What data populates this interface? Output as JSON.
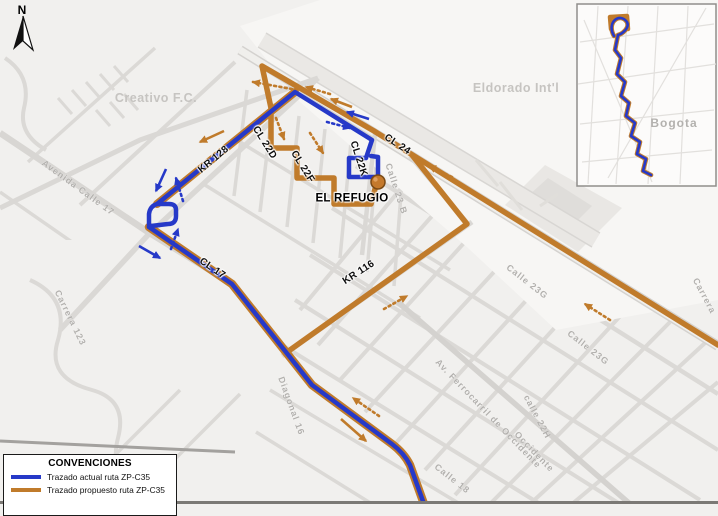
{
  "legend": {
    "title": "CONVENCIONES",
    "items": [
      {
        "label": "Trazado actual ruta ZP-C35",
        "color": "#2639c8"
      },
      {
        "label": "Trazado propuesto ruta ZP-C35",
        "color": "#c07b2b"
      }
    ]
  },
  "colors": {
    "route_current": "#2639c8",
    "route_proposed": "#c07b2b",
    "road": "#dbd9d6",
    "road_major": "#d4d2cf",
    "background": "#f1f0ee",
    "label_gray": "#b2b0ad",
    "stop_fill": "#c4792c",
    "stop_border": "#7a4a15",
    "frame": "#7b7975"
  },
  "stop": {
    "name": "EL REFUGIO",
    "x": 378,
    "y": 182
  },
  "inset": {
    "city_label": "Bogota"
  },
  "north_label": "N",
  "labels": [
    {
      "t": "N",
      "x": 22,
      "y": 10,
      "r": 0,
      "cls": "north",
      "name": "north-label"
    },
    {
      "t": "Creativo F.C.",
      "x": 156,
      "y": 98,
      "r": 0,
      "cls": "glbig",
      "name": "street-label"
    },
    {
      "t": "Eldorado Int'l",
      "x": 516,
      "y": 88,
      "r": 0,
      "cls": "glbig",
      "name": "airport-label"
    },
    {
      "t": "Avenida  Calle  17",
      "x": 78,
      "y": 188,
      "r": 36,
      "cls": "gl",
      "name": "street-label"
    },
    {
      "t": "KR 128",
      "x": 214,
      "y": 160,
      "r": -40,
      "cls": "rl",
      "name": "route-street-label"
    },
    {
      "t": "CL 22D",
      "x": 264,
      "y": 143,
      "r": 58,
      "cls": "rl",
      "name": "route-street-label"
    },
    {
      "t": "CL 22F",
      "x": 302,
      "y": 167,
      "r": 58,
      "cls": "rl",
      "name": "route-street-label"
    },
    {
      "t": "CL 22K",
      "x": 358,
      "y": 159,
      "r": 72,
      "cls": "rl",
      "name": "route-street-label"
    },
    {
      "t": "CL 24",
      "x": 397,
      "y": 145,
      "r": 33,
      "cls": "rl",
      "name": "route-street-label"
    },
    {
      "t": "CL 17",
      "x": 212,
      "y": 269,
      "r": 34,
      "cls": "rl",
      "name": "route-street-label"
    },
    {
      "t": "KR 116",
      "x": 359,
      "y": 273,
      "r": -33,
      "cls": "rl",
      "name": "route-street-label"
    },
    {
      "t": "EL REFUGIO",
      "x": 352,
      "y": 199,
      "r": 0,
      "cls": "refugio",
      "name": "stop-label"
    },
    {
      "t": "Calle 23 B",
      "x": 396,
      "y": 189,
      "r": 72,
      "cls": "gl",
      "name": "street-label"
    },
    {
      "t": "Calle 23G",
      "x": 527,
      "y": 282,
      "r": 38,
      "cls": "gl",
      "name": "street-label"
    },
    {
      "t": "Calle 23G",
      "x": 588,
      "y": 348,
      "r": 38,
      "cls": "gl",
      "name": "street-label"
    },
    {
      "t": "Carrera",
      "x": 704,
      "y": 296,
      "r": 62,
      "cls": "gl",
      "name": "street-label"
    },
    {
      "t": "Av. Ferrocarril de Occidente",
      "x": 488,
      "y": 414,
      "r": 46,
      "cls": "gl",
      "name": "street-label"
    },
    {
      "t": "calle 22H",
      "x": 537,
      "y": 417,
      "r": 62,
      "cls": "gl",
      "name": "street-label"
    },
    {
      "t": "Occidente",
      "x": 534,
      "y": 452,
      "r": 46,
      "cls": "gl",
      "name": "street-label"
    },
    {
      "t": "Diagonal  16",
      "x": 291,
      "y": 406,
      "r": 70,
      "cls": "gl",
      "name": "street-label"
    },
    {
      "t": "Calle 18",
      "x": 452,
      "y": 479,
      "r": 38,
      "cls": "gl",
      "name": "street-label"
    },
    {
      "t": "Carrera 123",
      "x": 70,
      "y": 318,
      "r": 64,
      "cls": "gl",
      "name": "street-label"
    },
    {
      "t": "Bogota",
      "x": 674,
      "y": 123,
      "r": 0,
      "cls": "city",
      "name": "inset-city-label"
    }
  ],
  "elements": [
    {
      "k": "rect",
      "x": 0,
      "y": 0,
      "w": 718,
      "h": 504,
      "f": "#f1f0ee",
      "name": "map-background"
    },
    {
      "k": "path",
      "d": "M332,208 L718,450",
      "w": 4,
      "c": "#dbd9d6",
      "name": "street"
    },
    {
      "k": "path",
      "d": "M310,255 L700,500",
      "w": 4,
      "c": "#dbd9d6",
      "name": "street"
    },
    {
      "k": "path",
      "d": "M295,300 L620,504",
      "w": 4,
      "c": "#dbd9d6",
      "name": "street"
    },
    {
      "k": "path",
      "d": "M282,345 L540,504",
      "w": 4,
      "c": "#dbd9d6",
      "name": "street"
    },
    {
      "k": "path",
      "d": "M270,390 L460,504",
      "w": 3.5,
      "c": "#dbd9d6",
      "name": "street"
    },
    {
      "k": "path",
      "d": "M256,432 L372,504",
      "w": 3.5,
      "c": "#dbd9d6",
      "name": "street"
    },
    {
      "k": "path",
      "d": "M356,166 L718,394",
      "w": 4.5,
      "c": "#dbd9d6",
      "name": "street"
    },
    {
      "k": "path",
      "d": "M418,168 L300,310",
      "w": 4,
      "c": "#dbd9d6",
      "name": "street"
    },
    {
      "k": "path",
      "d": "M455,190 L318,345",
      "w": 4,
      "c": "#dbd9d6",
      "name": "street"
    },
    {
      "k": "path",
      "d": "M492,212 L340,380",
      "w": 4,
      "c": "#dbd9d6",
      "name": "street"
    },
    {
      "k": "path",
      "d": "M528,235 L365,412",
      "w": 4,
      "c": "#dbd9d6",
      "name": "street"
    },
    {
      "k": "path",
      "d": "M565,258 L395,444",
      "w": 4,
      "c": "#dbd9d6",
      "name": "street"
    },
    {
      "k": "path",
      "d": "M600,278 L425,470",
      "w": 4,
      "c": "#dbd9d6",
      "name": "street"
    },
    {
      "k": "path",
      "d": "M635,300 L455,495",
      "w": 4,
      "c": "#dbd9d6",
      "name": "street"
    },
    {
      "k": "path",
      "d": "M670,322 L490,504",
      "w": 4,
      "c": "#dbd9d6",
      "name": "street"
    },
    {
      "k": "path",
      "d": "M705,343 L530,504",
      "w": 4,
      "c": "#dbd9d6",
      "name": "street"
    },
    {
      "k": "path",
      "d": "M718,382 L572,504",
      "w": 4,
      "c": "#dbd9d6",
      "name": "street"
    },
    {
      "k": "path",
      "d": "M273,103 L260,212",
      "w": 3.5,
      "c": "#dbd9d6",
      "name": "street"
    },
    {
      "k": "path",
      "d": "M299,116 L287,227",
      "w": 3.5,
      "c": "#dbd9d6",
      "name": "street"
    },
    {
      "k": "path",
      "d": "M325,129 L313,243",
      "w": 3.5,
      "c": "#dbd9d6",
      "name": "street"
    },
    {
      "k": "path",
      "d": "M351,142 L340,258",
      "w": 3.5,
      "c": "#dbd9d6",
      "name": "street"
    },
    {
      "k": "path",
      "d": "M377,155 L367,272",
      "w": 3.5,
      "c": "#dbd9d6",
      "name": "street"
    },
    {
      "k": "path",
      "d": "M403,168 L394,286",
      "w": 3.5,
      "c": "#dbd9d6",
      "name": "street"
    },
    {
      "k": "path",
      "d": "M247,90 L234,196",
      "w": 3.5,
      "c": "#dbd9d6",
      "name": "street"
    },
    {
      "k": "path",
      "d": "M240,142 L450,270",
      "w": 3.5,
      "c": "#dbd9d6",
      "name": "street"
    },
    {
      "k": "path",
      "d": "M205,185 L420,318",
      "w": 3.5,
      "c": "#dbd9d6",
      "name": "street"
    },
    {
      "k": "path",
      "d": "M235,62 L80,205",
      "w": 4,
      "c": "#dbd9d6",
      "name": "street"
    },
    {
      "k": "path",
      "d": "M155,48 L28,162",
      "w": 3.5,
      "c": "#dbd9d6",
      "name": "street"
    },
    {
      "k": "path",
      "d": "M0,192 L115,272",
      "w": 3.5,
      "c": "#dbd9d6",
      "name": "street"
    },
    {
      "k": "path",
      "d": "M0,262 L90,325",
      "w": 3,
      "c": "#dbd9d6",
      "name": "street"
    },
    {
      "k": "path",
      "d": "M0,352 L95,257",
      "w": 3.5,
      "c": "#dbd9d6",
      "name": "street"
    },
    {
      "k": "path",
      "d": "M20,430 L130,320",
      "w": 3.5,
      "c": "#dbd9d6",
      "name": "street"
    },
    {
      "k": "path",
      "d": "M70,500 L180,390",
      "w": 3.5,
      "c": "#dbd9d6",
      "name": "street"
    },
    {
      "k": "path",
      "d": "M130,504 L240,394",
      "w": 3.5,
      "c": "#dbd9d6",
      "name": "street"
    },
    {
      "k": "path",
      "d": "M58,98 L72,114 M72,90 L86,106 M86,82 L100,98 M100,74 L114,90 M114,66 L128,82 M96,110 L110,126 M110,102 L124,118 M124,94 L138,110",
      "w": 3,
      "c": "#dbd9d6",
      "name": "street-block-cluster"
    },
    {
      "k": "poly",
      "pts": "240,26 320,0 718,0 718,300 556,330 468,248 300,102",
      "f": "#f7f6f4",
      "name": "airport-area"
    },
    {
      "k": "poly",
      "pts": "0,240 118,240 150,300 132,420 60,504 0,504",
      "f": "#f1f0ee",
      "name": "open-area"
    },
    {
      "k": "poly",
      "pts": "505,205 545,165 622,208 578,252",
      "f": "#e9e7e4",
      "name": "airport-apron"
    },
    {
      "k": "poly",
      "pts": "528,196 548,178 592,206 572,226",
      "f": "#dfddda",
      "name": "airport-terminal"
    },
    {
      "k": "path",
      "d": "M262,40 L596,240",
      "w": 16,
      "c": "#eae8e5",
      "name": "runway"
    },
    {
      "k": "path",
      "d": "M258,47 L592,247",
      "w": 1.5,
      "c": "#d8d6d3",
      "name": "runway-edge"
    },
    {
      "k": "path",
      "d": "M266,33 L600,233",
      "w": 1.5,
      "c": "#d8d6d3",
      "name": "runway-edge"
    },
    {
      "k": "path",
      "d": "M500,182 L522,210 M540,206 L558,194 M476,160 L498,186",
      "w": 3,
      "c": "#e0deda",
      "name": "taxiway"
    },
    {
      "k": "path",
      "d": "M240,50 L718,346",
      "w": 10,
      "c": "#d4d2cf",
      "name": "road-cl24-casing"
    },
    {
      "k": "path",
      "d": "M240,50 L718,346",
      "w": 7,
      "c": "#f0efec",
      "name": "road-cl24"
    },
    {
      "k": "path",
      "d": "M318,78 L148,235 L60,330",
      "w": 5.5,
      "c": "#dad8d5",
      "name": "road-kr128"
    },
    {
      "k": "path",
      "d": "M0,133 L148,232 L232,284 L312,385 L392,444 Q404,453 410,465 L424,504",
      "w": 6.5,
      "c": "#d8d6d3",
      "name": "road-calle17"
    },
    {
      "k": "path",
      "d": "M398,302 L630,504",
      "w": 5.5,
      "c": "#d4d2cf",
      "name": "road-ferrocarril"
    },
    {
      "k": "path",
      "d": "M30,280 Q70,298 58,340 Q46,378 92,390 Q128,400 118,438 Q110,468 132,482",
      "w": 4,
      "c": "#dbd9d6",
      "name": "street"
    },
    {
      "k": "path",
      "d": "M5,58 Q32,76 24,108 Q18,134 46,150",
      "w": 4,
      "c": "#dbd9d6",
      "name": "street"
    },
    {
      "k": "path",
      "d": "M0,208 L140,140 L318,78",
      "w": 5,
      "c": "#dad8d5",
      "name": "street"
    },
    {
      "k": "path",
      "d": "M0,441 L235,452",
      "w": 3,
      "c": "#a3a19e",
      "name": "street-major"
    },
    {
      "k": "path",
      "d": "M472,222 L282,356",
      "w": 5,
      "c": "#dad8d5",
      "name": "road-kr116"
    },
    {
      "k": "path",
      "d": "M410,156 L470,226",
      "w": 4.5,
      "c": "#dad8d5",
      "name": "street"
    },
    {
      "k": "path",
      "d": "M375,134 L362,255",
      "w": 4.5,
      "c": "#dad8d5",
      "name": "road-cl22k"
    },
    {
      "k": "path",
      "d": "M295,92 L157,204",
      "w": 8,
      "c": "#c07b2b",
      "cap": "round",
      "name": "route-proposed-underlay"
    },
    {
      "k": "path",
      "d": "M149,227 L232,284 L312,385 L392,444 Q404,453 410,465 L424,504",
      "w": 8.5,
      "c": "#c07b2b",
      "cap": "round",
      "name": "route-proposed-underlay"
    },
    {
      "k": "path",
      "d": "M718,345 L374,131 L262,66 L271,108 L271,148 L297,148 L297,178 L334,178 L334,204 L371,204 L375,189",
      "w": 5.5,
      "c": "#c07b2b",
      "cap": "round",
      "name": "route-proposed"
    },
    {
      "k": "path",
      "d": "M412,155 L467,224 L290,350",
      "w": 5.5,
      "c": "#c07b2b",
      "cap": "round",
      "name": "route-proposed"
    },
    {
      "k": "path",
      "d": "M149,227 L149,214 Q150,206 157,204 L295,92 L372,140 L366,158 L349,158 L349,177 L378,177 L378,157 L371,156",
      "w": 4.5,
      "c": "#2639c8",
      "cap": "round",
      "name": "route-current"
    },
    {
      "k": "path",
      "d": "M151,226 L168,224 Q176,224 176,216 L176,210 Q176,204 169,204 L158,204",
      "w": 4.5,
      "c": "#2639c8",
      "cap": "round",
      "name": "route-current-loop"
    },
    {
      "k": "path",
      "d": "M149,227 L232,284 L312,385 L392,444 Q404,453 410,465 L424,504",
      "w": 4.5,
      "c": "#2639c8",
      "cap": "round",
      "name": "route-current"
    },
    {
      "k": "arrow",
      "x1": 166,
      "y1": 169,
      "x2": 156,
      "y2": 191,
      "c": "blue",
      "dot": false,
      "name": "direction-arrow-current"
    },
    {
      "k": "arrow",
      "x1": 139,
      "y1": 246,
      "x2": 160,
      "y2": 258,
      "c": "blue",
      "dot": false,
      "name": "direction-arrow-current"
    },
    {
      "k": "arrow",
      "x1": 369,
      "y1": 119,
      "x2": 347,
      "y2": 112,
      "c": "blue",
      "dot": false,
      "name": "direction-arrow-current"
    },
    {
      "k": "arrow",
      "x1": 183,
      "y1": 201,
      "x2": 176,
      "y2": 178,
      "c": "blue",
      "dot": true,
      "name": "direction-arrow-current-dotted"
    },
    {
      "k": "arrow",
      "x1": 171,
      "y1": 249,
      "x2": 178,
      "y2": 229,
      "c": "blue",
      "dot": true,
      "name": "direction-arrow-current-dotted"
    },
    {
      "k": "arrow",
      "x1": 327,
      "y1": 122,
      "x2": 350,
      "y2": 128,
      "c": "blue",
      "dot": true,
      "name": "direction-arrow-current-dotted"
    },
    {
      "k": "arrow",
      "x1": 224,
      "y1": 131,
      "x2": 200,
      "y2": 142,
      "c": "orange",
      "dot": false,
      "name": "direction-arrow-proposed"
    },
    {
      "k": "arrow",
      "x1": 352,
      "y1": 107,
      "x2": 331,
      "y2": 99,
      "c": "orange",
      "dot": false,
      "name": "direction-arrow-proposed"
    },
    {
      "k": "arrow",
      "x1": 341,
      "y1": 419,
      "x2": 366,
      "y2": 441,
      "c": "orange",
      "dot": false,
      "name": "direction-arrow-proposed"
    },
    {
      "k": "arrow",
      "x1": 330,
      "y1": 94,
      "x2": 306,
      "y2": 87,
      "c": "orange",
      "dot": true,
      "name": "direction-arrow-proposed-dotted"
    },
    {
      "k": "arrow",
      "x1": 292,
      "y1": 89,
      "x2": 253,
      "y2": 82,
      "c": "orange",
      "dot": true,
      "name": "direction-arrow-proposed-dotted"
    },
    {
      "k": "arrow",
      "x1": 276,
      "y1": 118,
      "x2": 284,
      "y2": 139,
      "c": "orange",
      "dot": true,
      "name": "direction-arrow-proposed-dotted"
    },
    {
      "k": "arrow",
      "x1": 310,
      "y1": 133,
      "x2": 323,
      "y2": 153,
      "c": "orange",
      "dot": true,
      "name": "direction-arrow-proposed-dotted"
    },
    {
      "k": "arrow",
      "x1": 452,
      "y1": 177,
      "x2": 429,
      "y2": 166,
      "c": "orange",
      "dot": true,
      "name": "direction-arrow-proposed-dotted"
    },
    {
      "k": "arrow",
      "x1": 384,
      "y1": 309,
      "x2": 407,
      "y2": 296,
      "c": "orange",
      "dot": true,
      "name": "direction-arrow-proposed-dotted"
    },
    {
      "k": "arrow",
      "x1": 379,
      "y1": 416,
      "x2": 353,
      "y2": 398,
      "c": "orange",
      "dot": true,
      "name": "direction-arrow-proposed-dotted"
    },
    {
      "k": "arrow",
      "x1": 610,
      "y1": 320,
      "x2": 585,
      "y2": 304,
      "c": "orange",
      "dot": true,
      "name": "direction-arrow-proposed-dotted"
    },
    {
      "k": "circle",
      "cx": 378,
      "cy": 182,
      "r": 7,
      "f": "#c4792c",
      "s": "#7a4a15",
      "sw": 1.5,
      "name": "el-refugio-marker"
    },
    {
      "k": "circle",
      "cx": 375.5,
      "cy": 179.5,
      "r": 2.2,
      "f": "#dfa05f",
      "name": "el-refugio-marker-highlight"
    },
    {
      "k": "rect",
      "x": 577,
      "y": 4,
      "w": 139,
      "h": 182,
      "f": "#fcfbfa",
      "s": "#908e8b",
      "sw": 1.5,
      "name": "inset-map"
    },
    {
      "k": "path",
      "d": "M580,42 L714,24",
      "w": 1.2,
      "c": "#e2e0dd",
      "name": "inset-street"
    },
    {
      "k": "path",
      "d": "M578,84 L716,64",
      "w": 1.2,
      "c": "#e2e0dd",
      "name": "inset-street"
    },
    {
      "k": "path",
      "d": "M580,124 L714,110",
      "w": 1.2,
      "c": "#e2e0dd",
      "name": "inset-street"
    },
    {
      "k": "path",
      "d": "M582,162 L712,150",
      "w": 1.2,
      "c": "#e2e0dd",
      "name": "inset-street"
    },
    {
      "k": "path",
      "d": "M598,6 L588,184",
      "w": 1.2,
      "c": "#e2e0dd",
      "name": "inset-street"
    },
    {
      "k": "path",
      "d": "M628,6 L616,184",
      "w": 1.2,
      "c": "#e2e0dd",
      "name": "inset-street"
    },
    {
      "k": "path",
      "d": "M658,6 L648,184",
      "w": 1.2,
      "c": "#e2e0dd",
      "name": "inset-street"
    },
    {
      "k": "path",
      "d": "M688,6 L680,184",
      "w": 1.2,
      "c": "#e2e0dd",
      "name": "inset-street"
    },
    {
      "k": "path",
      "d": "M706,8 L608,178",
      "w": 1.2,
      "c": "#e2e0dd",
      "name": "inset-street"
    },
    {
      "k": "path",
      "d": "M584,20 L652,182",
      "w": 1.2,
      "c": "#e2e0dd",
      "name": "inset-street"
    },
    {
      "k": "path",
      "d": "M614,36 C606,22 620,12 627,22 C630,28 622,34 618,35 L615,50 L621,58 L617,74 L625,82 L621,96 L629,103 L626,116 L635,123 L631,136 L640,142 L637,154 L646,159 L643,171 L651,175",
      "w": 4.6,
      "c": "#c07b2b",
      "cap": "round",
      "name": "inset-route-proposed-underlay"
    },
    {
      "k": "path",
      "d": "M611,29 L610,17 L627,16 L628,29",
      "w": 4.5,
      "c": "#c07b2b",
      "cap": "round",
      "name": "inset-route-proposed-loop"
    },
    {
      "k": "path",
      "d": "M614,36 C606,22 620,12 627,22 C630,28 622,34 618,35 L615,50 L621,58 L617,74 L625,82 L621,96 L629,103 L626,116 L635,123 L631,136 L640,142 L637,154 L646,159 L643,171 L651,175",
      "w": 2.6,
      "c": "#2639c8",
      "cap": "round",
      "name": "inset-route-current"
    },
    {
      "k": "rect",
      "x": 0,
      "y": 501,
      "w": 718,
      "h": 3,
      "f": "#7b7975",
      "name": "map-frame-bottom"
    },
    {
      "k": "poly",
      "pts": "23,16 13,50 23,41",
      "f": "#111111",
      "name": "north-arrow-icon"
    },
    {
      "k": "poly",
      "pts": "23,16 33,50 23,41",
      "f": "#ffffff",
      "s": "#111111",
      "sw": 1.2,
      "name": "north-arrow-icon"
    }
  ]
}
